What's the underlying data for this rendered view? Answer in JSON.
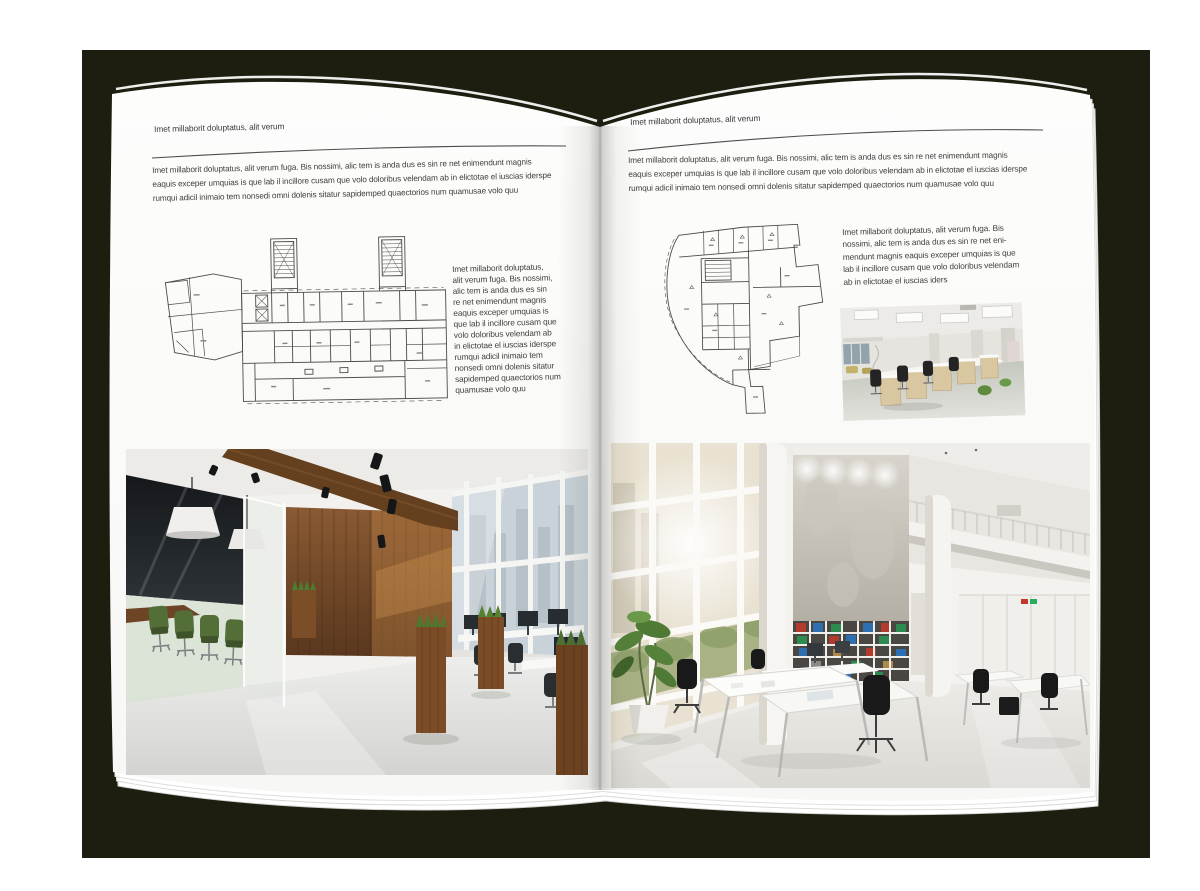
{
  "colors": {
    "backdrop": "#1d1e10",
    "paper": "#fdfdfc",
    "text": "#3d3d3d"
  },
  "left_page": {
    "header": "Imet millaborit doluptatus, alit verum",
    "intro": "Imet millaborit doluptatus, alit verum fuga. Bis nossimi, alic tem is anda dus es sin re net enimendunt magnis\neaquis exceper umquias is que lab il incillore cusam que volo doloribus velendam ab in elictotae el iuscias iderspe\nrumqui adicil inimaio tem nonsedi omni dolenis sitatur sapidemped quaectorios num quamusae volo quu",
    "caption": "Imet millaborit doluptatus,\nalit verum fuga. Bis nossimi,\nalic tem is anda dus es sin\nre net enimendunt magnis\neaquis exceper umquias is\nque lab il incillore cusam que\nvolo doloribus velendam ab\nin elictotae el iuscias iderspe\nrumqui adicil inimaio tem\nnonsedi omni dolenis sitatur\nsapidemped quaectorios num\nquamusae volo quu"
  },
  "right_page": {
    "header": "Imet millaborit doluptatus, alit verum",
    "intro": "Imet millaborit doluptatus, alit verum fuga. Bis nossimi, alic tem is anda dus es sin re net enimendunt magnis\neaquis exceper umquias is que lab il incillore cusam que volo doloribus velendam ab in elictotae el iuscias iderspe\nrumqui adicil inimaio tem nonsedi omni dolenis sitatur sapidemped quaectorios num quamusae volo quu",
    "caption": "Imet millaborit doluptatus, alit verum fuga. Bis\nnossimi, alic tem is anda dus es sin re net eni-\nmendunt magnis eaquis exceper umquias is que\nlab il incillore cusam que volo doloribus velendam\nab in elictotae el iuscias iders"
  }
}
